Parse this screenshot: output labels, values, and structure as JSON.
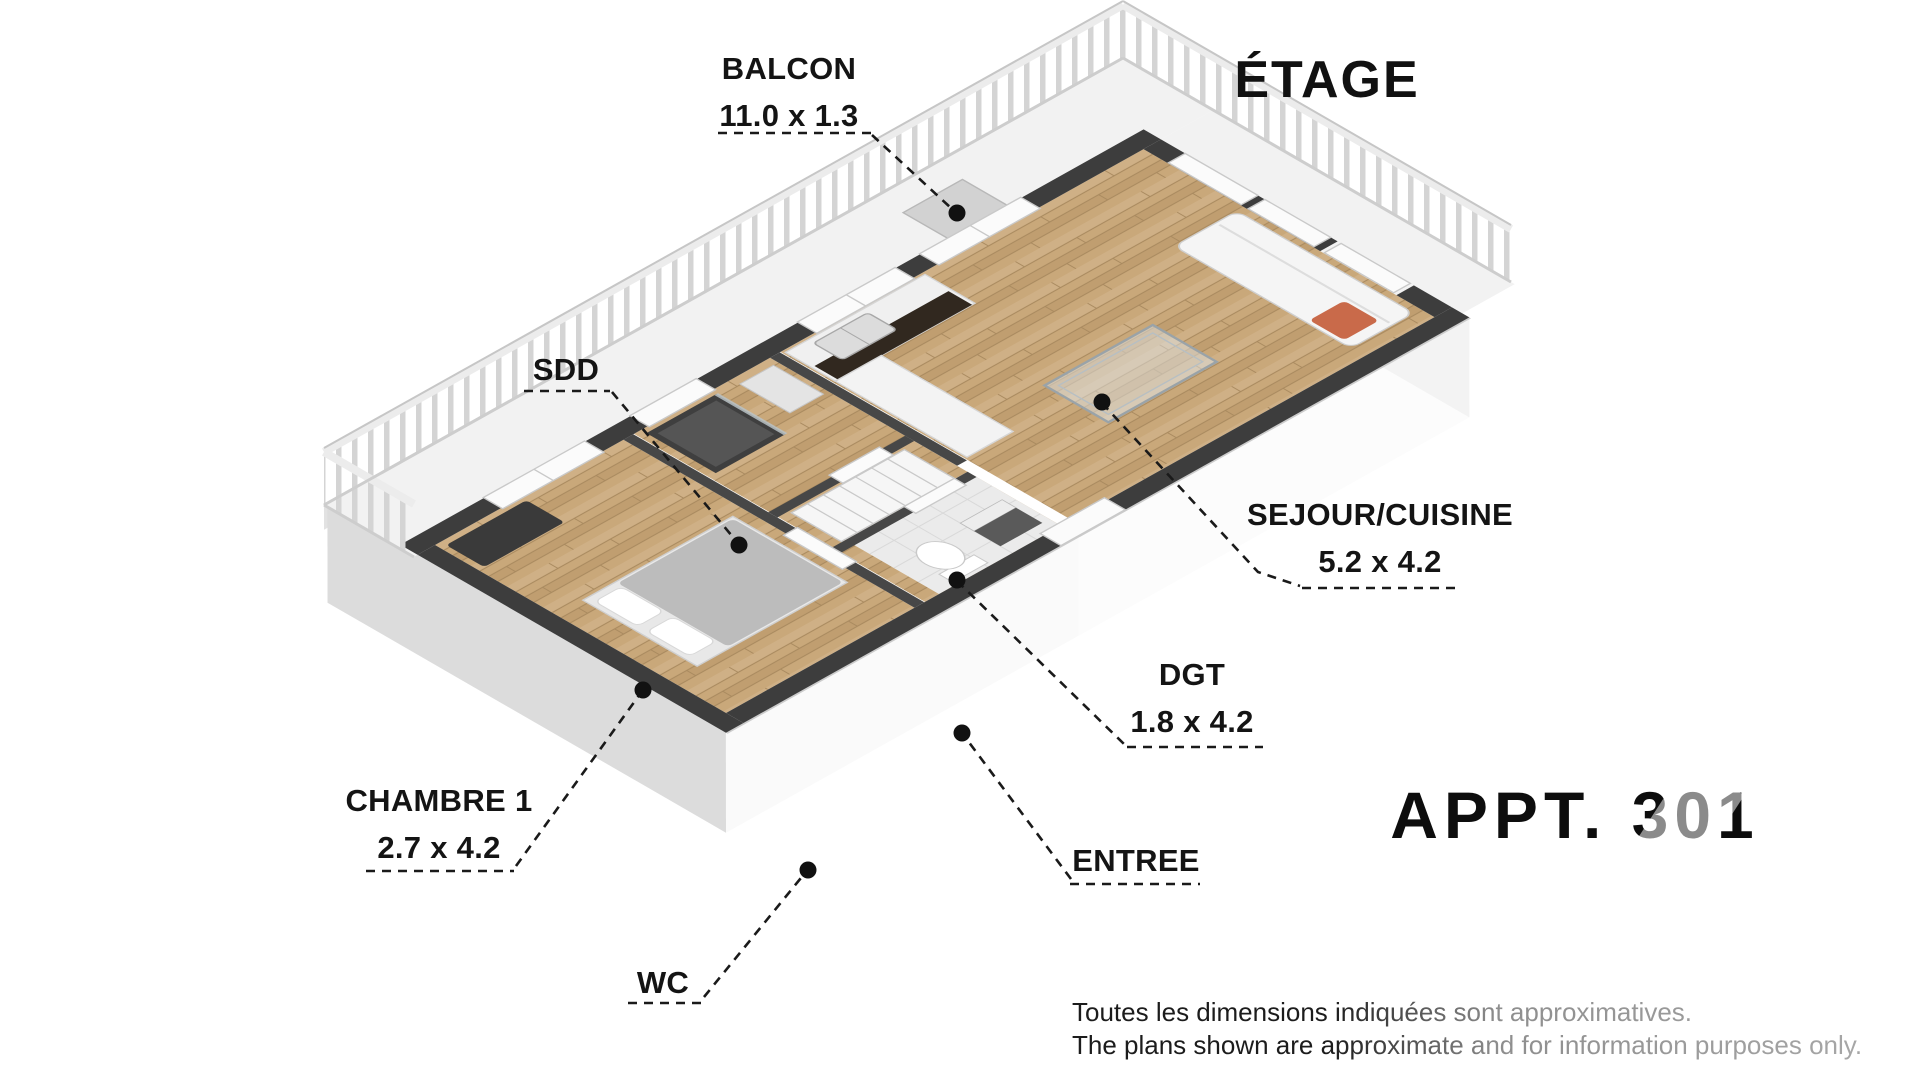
{
  "title": "ÉTAGE",
  "apartment": "APPT. 301",
  "rooms": {
    "balcon": {
      "name": "BALCON",
      "dim": "11.0 x 1.3"
    },
    "sdd": {
      "name": "SDD"
    },
    "sejour": {
      "name": "SEJOUR/CUISINE",
      "dim": "5.2 x 4.2"
    },
    "dgt": {
      "name": "DGT",
      "dim": "1.8 x 4.2"
    },
    "chambre": {
      "name": "CHAMBRE 1",
      "dim": "2.7 x 4.2"
    },
    "entree": {
      "name": "ENTREE"
    },
    "wc": {
      "name": "WC"
    }
  },
  "disclaimer": {
    "line1": "Toutes les dimensions indiquées sont approximatives.",
    "line2": "The plans shown are approximate and for information purposes only."
  },
  "colors": {
    "label_text": "#141414",
    "wall_exterior": "#3d3d3d",
    "wall_interior": "#474747",
    "floor_wood": "#c9a87a",
    "balcony_floor": "#f2f2f2",
    "sofa_cushion_accent": "#c96a4a"
  }
}
